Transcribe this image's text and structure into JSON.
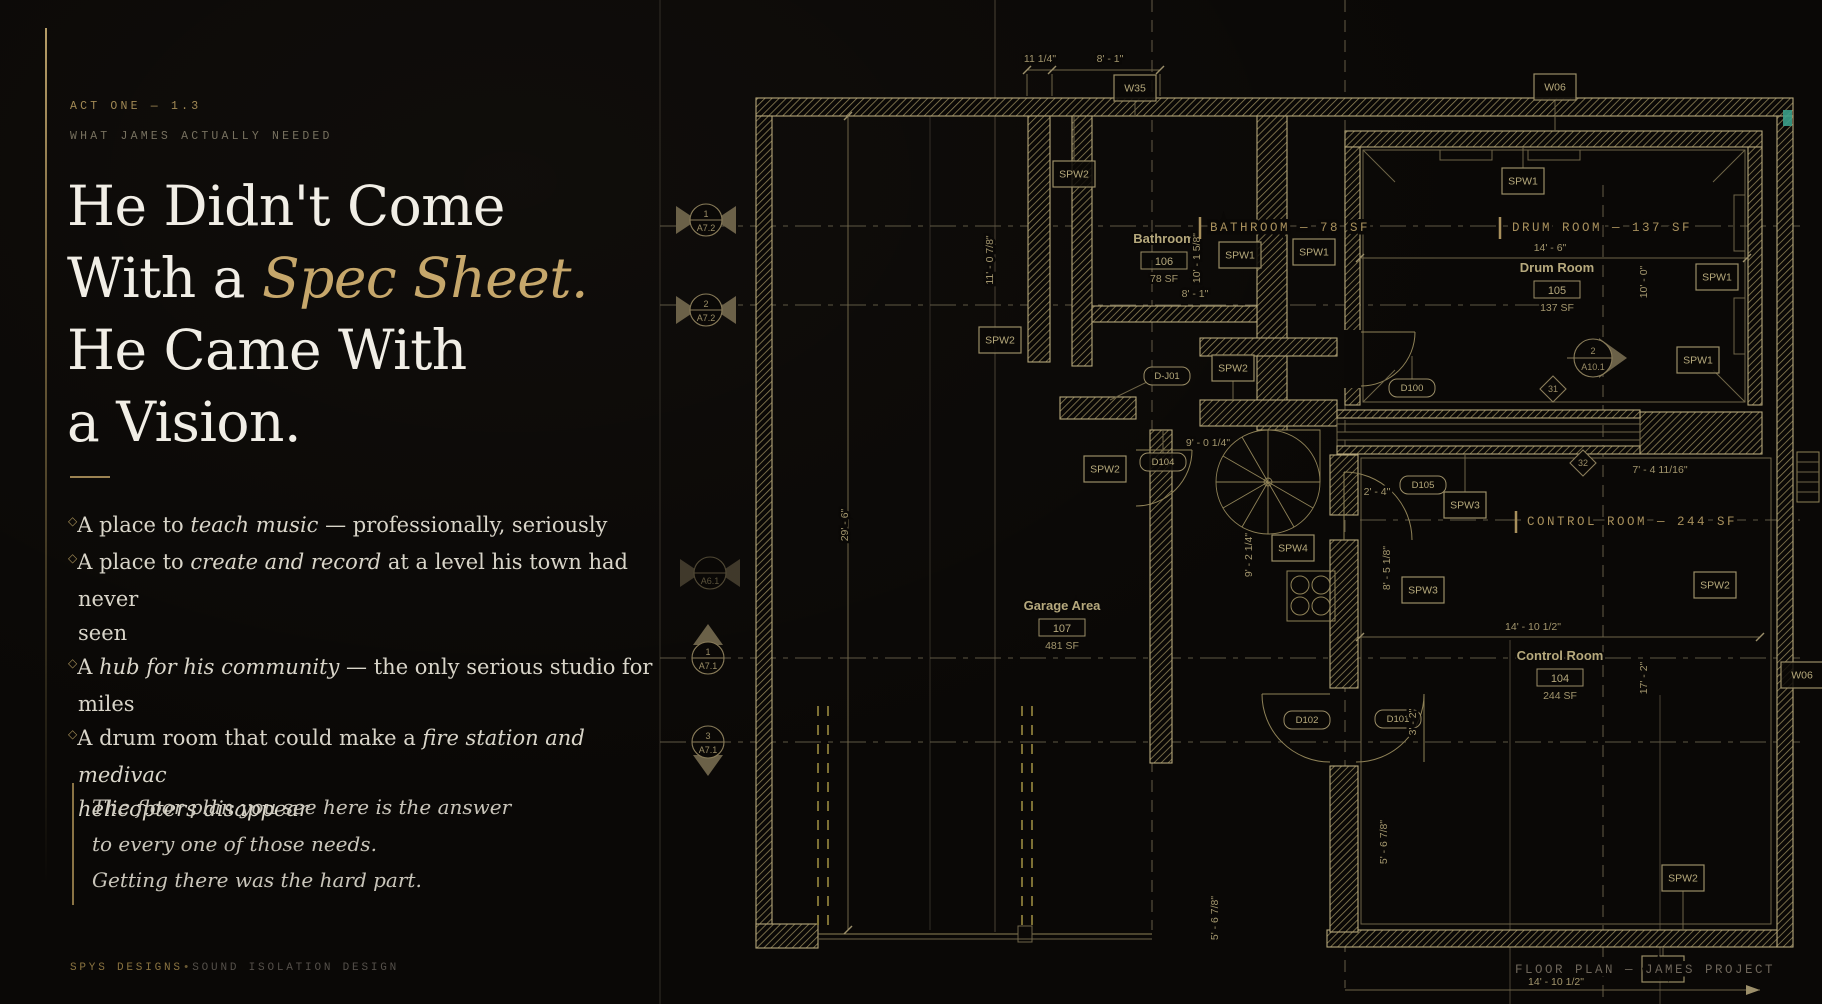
{
  "left": {
    "kicker": "ACT ONE — 1.3",
    "eyebrow": "WHAT JAMES ACTUALLY NEEDED",
    "headline": {
      "l1": "He Didn't Come",
      "l2_pre": "With a ",
      "l2_em": "Spec Sheet.",
      "l3": "He Came With",
      "l4": "a Vision."
    },
    "marker": "◇",
    "bullets": [
      [
        [
          "A place to ",
          0
        ],
        [
          "teach music",
          1
        ],
        [
          " — professionally, seriously",
          0
        ]
      ],
      [
        [
          "A place to ",
          0
        ],
        [
          "create and record",
          1
        ],
        [
          " at a level his town had never",
          0
        ],
        [
          "",
          2
        ],
        [
          "seen",
          0
        ]
      ],
      [
        [
          "A ",
          0
        ],
        [
          "hub for his community",
          1
        ],
        [
          " — the only serious studio for",
          0
        ],
        [
          "",
          2
        ],
        [
          "miles",
          0
        ]
      ],
      [
        [
          "A drum room that could make a ",
          0
        ],
        [
          "fire station and medivac",
          1
        ],
        [
          "",
          2
        ],
        [
          "helicopters disappear",
          1
        ]
      ]
    ],
    "quote": "The floor plan you see here is the answer\nto every one of those needs.\nGetting there was the hard part.",
    "footer": {
      "brand": "SPYS DESIGNS",
      "separator": "•",
      "tagline": "SOUND ISOLATION DESIGN"
    }
  },
  "plan": {
    "overlay_labels": [
      {
        "text": "BATHROOM — 78 SF",
        "x": 1210,
        "y": 231,
        "tick_x": 1200,
        "muted": false
      },
      {
        "text": "DRUM ROOM — 137 SF",
        "x": 1512,
        "y": 231,
        "tick_x": 1500,
        "muted": false
      },
      {
        "text": "CONTROL ROOM — 244 SF",
        "x": 1527,
        "y": 525,
        "tick_x": 1516,
        "muted": false
      },
      {
        "text": "FLOOR PLAN — JAMES PROJECT",
        "x": 1515,
        "y": 973,
        "muted": true
      }
    ],
    "rooms": [
      {
        "name": "Bathroom",
        "number": "106",
        "area": "78 SF",
        "x": 1164,
        "y": 243
      },
      {
        "name": "Drum Room",
        "number": "105",
        "area": "137 SF",
        "x": 1557,
        "y": 272
      },
      {
        "name": "Garage Area",
        "number": "107",
        "area": "481 SF",
        "x": 1062,
        "y": 610
      },
      {
        "name": "Control Room",
        "number": "104",
        "area": "244 SF",
        "x": 1560,
        "y": 660
      }
    ],
    "wall_tags": [
      {
        "label": "W35",
        "x": 1135,
        "y": 88
      },
      {
        "label": "W06",
        "x": 1555,
        "y": 87
      },
      {
        "label": "SPW2",
        "x": 1074,
        "y": 174
      },
      {
        "label": "SPW1",
        "x": 1523,
        "y": 181
      },
      {
        "label": "SPW1",
        "x": 1240,
        "y": 255
      },
      {
        "label": "SPW1",
        "x": 1314,
        "y": 252
      },
      {
        "label": "SPW1",
        "x": 1717,
        "y": 277
      },
      {
        "label": "SPW1",
        "x": 1698,
        "y": 360
      },
      {
        "label": "SPW2",
        "x": 1000,
        "y": 340
      },
      {
        "label": "SPW2",
        "x": 1233,
        "y": 368
      },
      {
        "label": "SPW2",
        "x": 1105,
        "y": 469
      },
      {
        "label": "SPW3",
        "x": 1465,
        "y": 505
      },
      {
        "label": "SPW4",
        "x": 1293,
        "y": 548
      },
      {
        "label": "SPW3",
        "x": 1423,
        "y": 590
      },
      {
        "label": "SPW2",
        "x": 1715,
        "y": 585
      },
      {
        "label": "W06",
        "x": 1802,
        "y": 675
      },
      {
        "label": "SPW2",
        "x": 1683,
        "y": 878
      },
      {
        "label": "W06",
        "x": 1663,
        "y": 969
      }
    ],
    "door_tags": [
      {
        "label": "D-J01",
        "x": 1167,
        "y": 376
      },
      {
        "label": "D104",
        "x": 1163,
        "y": 462
      },
      {
        "label": "D100",
        "x": 1412,
        "y": 388
      },
      {
        "label": "D105",
        "x": 1423,
        "y": 485
      },
      {
        "label": "D102",
        "x": 1307,
        "y": 720
      },
      {
        "label": "D101",
        "x": 1398,
        "y": 719
      }
    ],
    "dims": [
      {
        "text": "11 1/4\"",
        "x": 1040,
        "y": 62,
        "rot": false
      },
      {
        "text": "8' - 1\"",
        "x": 1110,
        "y": 62,
        "rot": false
      },
      {
        "text": "11' - 0 7/8\"",
        "x": 993,
        "y": 260,
        "rot": true
      },
      {
        "text": "10' - 1 5/8\"",
        "x": 1200,
        "y": 258,
        "rot": true
      },
      {
        "text": "8' - 1\"",
        "x": 1195,
        "y": 297,
        "rot": false
      },
      {
        "text": "14' - 6\"",
        "x": 1550,
        "y": 251,
        "rot": false
      },
      {
        "text": "10' - 0\"",
        "x": 1647,
        "y": 282,
        "rot": true
      },
      {
        "text": "29' - 6\"",
        "x": 848,
        "y": 525,
        "rot": true
      },
      {
        "text": "9' - 0 1/4\"",
        "x": 1208,
        "y": 446,
        "rot": false
      },
      {
        "text": "9' - 2 1/4\"",
        "x": 1252,
        "y": 555,
        "rot": true
      },
      {
        "text": "2' - 4\"",
        "x": 1377,
        "y": 495,
        "rot": false
      },
      {
        "text": "8' - 5 1/8\"",
        "x": 1390,
        "y": 568,
        "rot": true
      },
      {
        "text": "7' - 4 11/16\"",
        "x": 1660,
        "y": 473,
        "rot": false
      },
      {
        "text": "14' - 10 1/2\"",
        "x": 1533,
        "y": 630,
        "rot": false
      },
      {
        "text": "17' - 2\"",
        "x": 1647,
        "y": 678,
        "rot": true
      },
      {
        "text": "3' - 2\"",
        "x": 1416,
        "y": 722,
        "rot": true
      },
      {
        "text": "5' - 6 7/8\"",
        "x": 1387,
        "y": 842,
        "rot": true
      },
      {
        "text": "5' - 6 7/8\"",
        "x": 1218,
        "y": 918,
        "rot": true
      },
      {
        "text": "14' - 10 1/2\"",
        "x": 1556,
        "y": 985,
        "rot": false
      }
    ],
    "grid_bubbles": [
      {
        "num": "1",
        "sheet": "A7.2",
        "x": 706,
        "y": 220,
        "tri": "lr",
        "dim": false
      },
      {
        "num": "2",
        "sheet": "A7.2",
        "x": 706,
        "y": 310,
        "tri": "lr",
        "dim": false
      },
      {
        "num": "",
        "sheet": "A6.1",
        "x": 710,
        "y": 573,
        "tri": "lr",
        "dim": true
      },
      {
        "num": "1",
        "sheet": "A7.1",
        "x": 708,
        "y": 658,
        "tri": "up",
        "dim": false
      },
      {
        "num": "3",
        "sheet": "A7.1",
        "x": 708,
        "y": 742,
        "tri": "down",
        "dim": false
      }
    ],
    "section_bubble": {
      "num": "2",
      "sheet": "A10.1",
      "x": 1593,
      "y": 358
    },
    "diamond_tags": [
      {
        "label": "31",
        "x": 1553,
        "y": 389
      },
      {
        "label": "32",
        "x": 1583,
        "y": 463
      }
    ],
    "colors": {
      "accent_gold": "#c6a76b",
      "plan_line": "#b5a77a",
      "overlay_gold": "#a8905c",
      "teal": "#3aa089"
    }
  }
}
